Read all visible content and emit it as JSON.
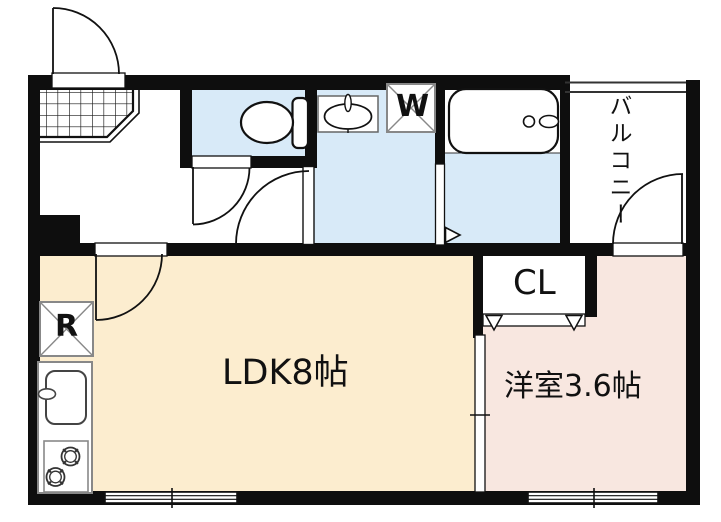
{
  "colors": {
    "wall": "#0e0e0e",
    "wet_area": "#D8EAF8",
    "ldk": "#FCEDCF",
    "bedroom": "#F8E7E0",
    "background": "#FFFFFF",
    "fixture_outline": "#888888"
  },
  "labels": {
    "ldk": "LDK8帖",
    "bedroom": "洋室3.6帖",
    "closet": "CL",
    "balcony": "バルコニー",
    "washer": "W",
    "refrigerator": "R"
  }
}
